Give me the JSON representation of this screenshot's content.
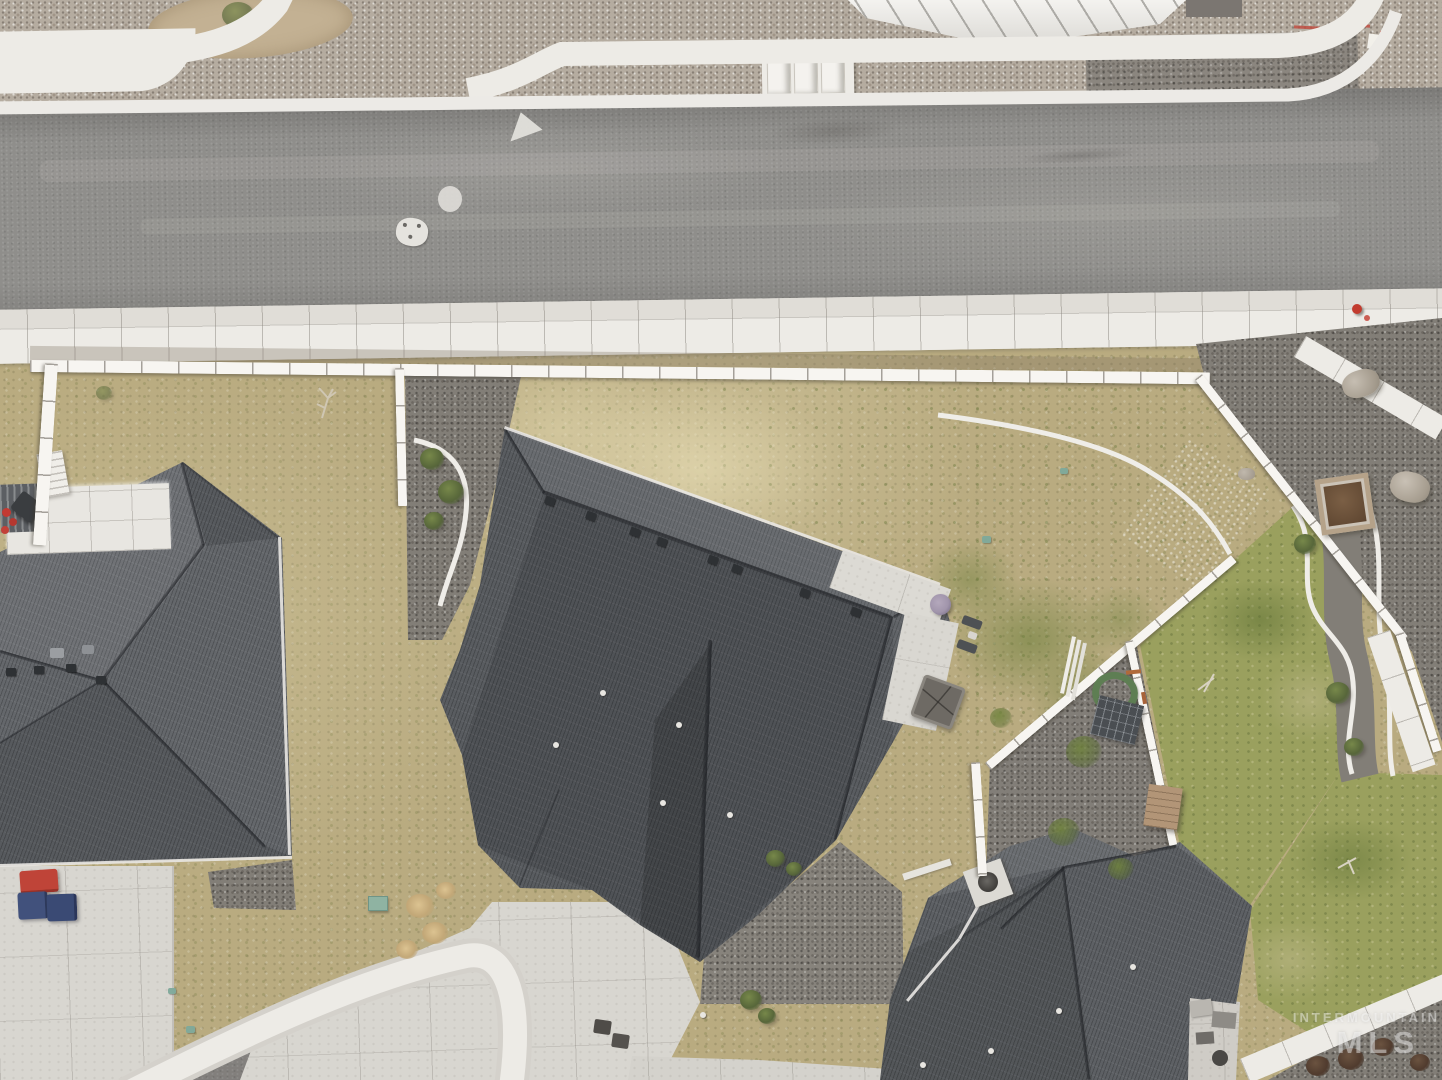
{
  "palette": {
    "grassDry": "#b9ab80",
    "grassPale": "#cfc4a2",
    "grassGreen": "#7f9050",
    "lawnRight": "#9aa05e",
    "gravelLight": "#b5aca0",
    "gravelDark": "#827e77",
    "gravelPad": "#8b867f",
    "road": "#8f8e8b",
    "roadLight": "#a7a5a1",
    "culdesac": "#908d8a",
    "concrete": "#d8d6d0",
    "walkWhite": "#edebe6",
    "fenceWhite": "#f7f5f1",
    "curbLine": "#d4d1cb",
    "roofDark": "#595c60",
    "roofLeft": "#64676b",
    "roofRight": "#5d6064",
    "ridge": "#35383c",
    "fascia": "#e9e7e3",
    "dirtTan": "#c3b193",
    "binRed": "#bf4438",
    "binBlue": "#41517c",
    "boxGreen": "#8fb3a2",
    "hoseGreen": "#5e7e53",
    "plume": "#dcc391",
    "wood": "#b29577",
    "plankDark": "#6b5036",
    "hydrant": "#c23b2e",
    "paint": "#c24a3d",
    "umbrella": "#a195ab",
    "watermark": "rgba(255,255,255,0.42)"
  },
  "watermark": {
    "line1": "INTERMOUNTAIN",
    "line2": "MLS"
  }
}
